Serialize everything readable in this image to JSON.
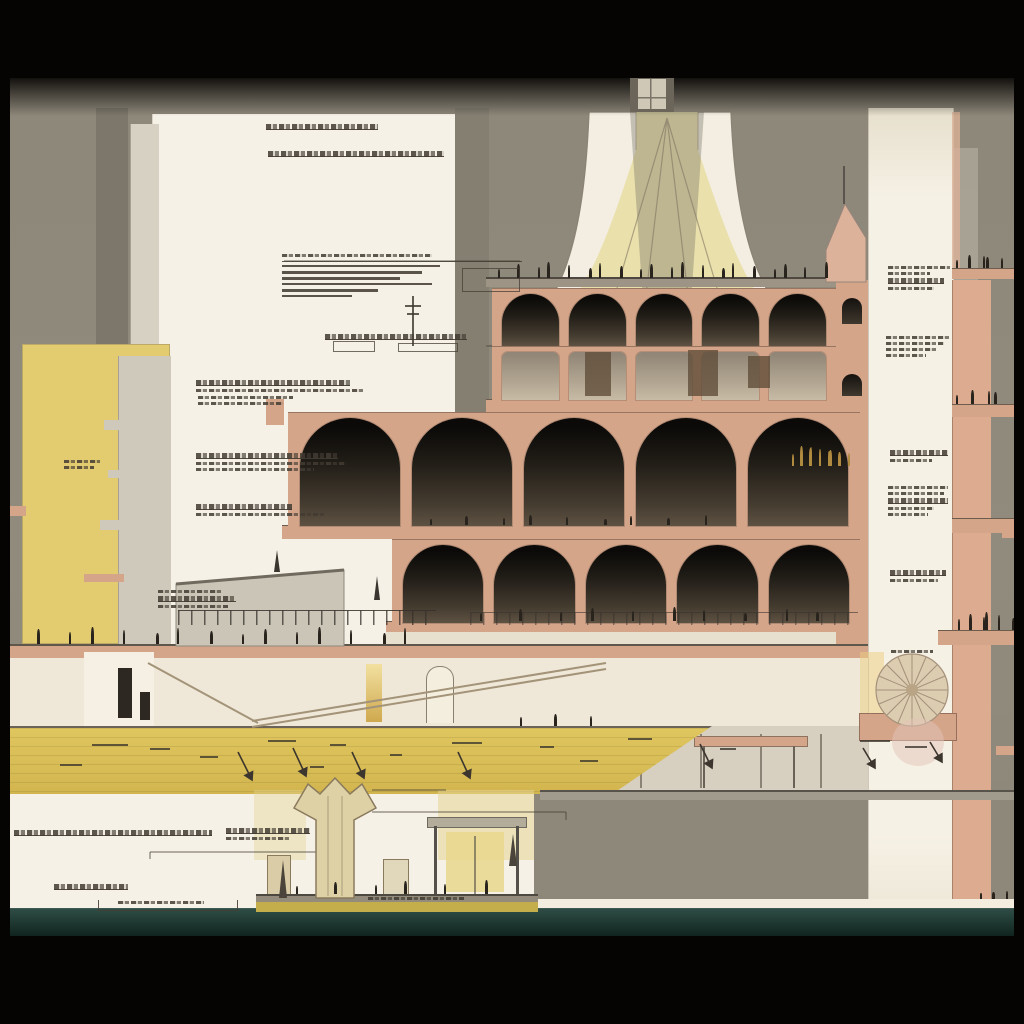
{
  "meta": {
    "description": "Architectural cross-section illustration: multi-storey arcaded building with flared pale-yellow dome, yellow tower, annotation callouts, yellow ramp deck, waterside pavilion with trumpet column, white pier column and salmon balconies with figure silhouettes, framed in black",
    "style": "sepia sectional drawing"
  },
  "palette": {
    "bg": "#8d8779",
    "paper": "#f6f1e7",
    "paper-dim": "#efe8d8",
    "salmon": "#d5a58a",
    "salmon2": "#dcab90",
    "ytower": "#e3cb70",
    "deck-yellow": "#dcc15c",
    "dome-fabric": "#e9e0ab",
    "dome-rim": "#f3eee1",
    "water-top": "#2e4d45",
    "water-bottom": "#0d1f1b",
    "ink": "#474037",
    "fig": "#28231c",
    "gold-fig": "#b08a3e",
    "glow": "#e9d88e",
    "frame": "#050403"
  },
  "scene": {
    "arch_rows": [
      {
        "x": 492,
        "y": 288,
        "w": 344,
        "h": 58,
        "count": 5,
        "pier": 10,
        "fill": "dark"
      },
      {
        "x": 492,
        "y": 346,
        "w": 344,
        "h": 54,
        "count": 5,
        "pier": 10,
        "fill": "light"
      },
      {
        "x": 288,
        "y": 412,
        "w": 572,
        "h": 114,
        "count": 5,
        "pier": 12,
        "fill": "dark"
      },
      {
        "x": 392,
        "y": 539,
        "w": 468,
        "h": 84,
        "count": 5,
        "pier": 11,
        "fill": "dark"
      }
    ],
    "panels": [
      [
        585,
        352,
        26,
        44
      ],
      [
        688,
        350,
        30,
        46
      ],
      [
        748,
        356,
        22,
        32
      ]
    ],
    "rails": [
      {
        "x": 178,
        "y": 610,
        "w": 258,
        "h": 14,
        "o": 0.95
      },
      {
        "x": 470,
        "y": 612,
        "w": 388,
        "h": 12,
        "o": 0.65
      }
    ],
    "figures": [
      {
        "x": 498,
        "y": 258,
        "w": 336,
        "count": 20,
        "min": 9,
        "vr": 8,
        "h": 20
      },
      {
        "x": 430,
        "y": 507,
        "w": 300,
        "count": 9,
        "min": 6,
        "vr": 5
      },
      {
        "x": 792,
        "y": 444,
        "w": 54,
        "count": 9,
        "min": 12,
        "vr": 9,
        "h": 22,
        "color": "#b08a3e"
      },
      {
        "x": 6,
        "y": 626,
        "w": 428,
        "count": 15,
        "min": 10,
        "vr": 8
      },
      {
        "x": 480,
        "y": 603,
        "w": 372,
        "count": 10,
        "min": 8,
        "vr": 7
      },
      {
        "x": 520,
        "y": 708,
        "w": 96,
        "count": 3,
        "min": 9,
        "vr": 5
      },
      {
        "x": 956,
        "y": 386,
        "w": 52,
        "count": 4,
        "min": 9,
        "vr": 6
      },
      {
        "x": 958,
        "y": 612,
        "w": 56,
        "count": 6,
        "min": 11,
        "vr": 8
      },
      {
        "x": 956,
        "y": 250,
        "w": 52,
        "count": 5,
        "min": 8,
        "vr": 6
      },
      {
        "x": 296,
        "y": 876,
        "w": 218,
        "count": 6,
        "min": 8,
        "vr": 7
      },
      {
        "x": 980,
        "y": 881,
        "w": 30,
        "count": 3,
        "min": 6,
        "vr": 4
      }
    ],
    "annotations": [
      {
        "x": 266,
        "y": 124,
        "lines": [
          {
            "w": 112,
            "u": 1
          }
        ]
      },
      {
        "x": 268,
        "y": 151,
        "lines": [
          {
            "w": 176,
            "u": 1
          }
        ]
      },
      {
        "x": 325,
        "y": 334,
        "lines": [
          {
            "w": 142,
            "u": 1
          }
        ]
      },
      {
        "x": 196,
        "y": 380,
        "lines": [
          {
            "w": 154,
            "u": 1
          },
          {
            "w": 168
          }
        ]
      },
      {
        "x": 196,
        "y": 394,
        "lines": []
      },
      {
        "x": 198,
        "y": 396,
        "lines": [
          {
            "w": 95
          },
          {
            "w": 85
          }
        ]
      },
      {
        "x": 64,
        "y": 460,
        "lines": [
          {
            "w": 36
          },
          {
            "w": 30
          }
        ]
      },
      {
        "x": 196,
        "y": 453,
        "lines": [
          {
            "w": 142,
            "u": 1
          },
          {
            "w": 150
          },
          {
            "w": 118
          }
        ]
      },
      {
        "x": 196,
        "y": 504,
        "lines": [
          {
            "w": 96,
            "u": 1
          },
          {
            "w": 128
          }
        ]
      },
      {
        "x": 158,
        "y": 590,
        "lines": [
          {
            "w": 64
          },
          {
            "w": 78,
            "u": 1
          },
          {
            "w": 70
          }
        ]
      },
      {
        "x": 888,
        "y": 266,
        "lines": [
          {
            "w": 62
          },
          {
            "w": 42
          },
          {
            "w": 56,
            "u": 1
          },
          {
            "w": 46
          }
        ]
      },
      {
        "x": 886,
        "y": 336,
        "lines": [
          {
            "w": 64
          },
          {
            "w": 58
          },
          {
            "w": 50
          },
          {
            "w": 40
          }
        ]
      },
      {
        "x": 890,
        "y": 450,
        "lines": [
          {
            "w": 58,
            "u": 1
          },
          {
            "w": 42
          }
        ]
      },
      {
        "x": 888,
        "y": 486,
        "lines": [
          {
            "w": 60
          },
          {
            "w": 56
          },
          {
            "w": 60,
            "u": 1
          },
          {
            "w": 46
          },
          {
            "w": 40
          }
        ]
      },
      {
        "x": 890,
        "y": 570,
        "lines": [
          {
            "w": 56,
            "u": 1
          },
          {
            "w": 48
          }
        ]
      },
      {
        "x": 891,
        "y": 650,
        "lines": [
          {
            "w": 42
          }
        ]
      },
      {
        "x": 14,
        "y": 830,
        "lines": [
          {
            "w": 198,
            "u": 1
          }
        ]
      },
      {
        "x": 226,
        "y": 828,
        "lines": [
          {
            "w": 84,
            "u": 1
          },
          {
            "w": 64
          }
        ]
      },
      {
        "x": 54,
        "y": 884,
        "lines": [
          {
            "w": 74,
            "u": 1
          }
        ]
      },
      {
        "x": 118,
        "y": 901,
        "lines": [
          {
            "w": 86
          }
        ]
      },
      {
        "x": 368,
        "y": 897,
        "lines": [
          {
            "w": 96
          }
        ]
      },
      {
        "x": 282,
        "y": 254,
        "lines": [
          {
            "w": 150
          }
        ]
      }
    ],
    "bars": [
      [
        282,
        261,
        240,
        1
      ],
      [
        282,
        265,
        158,
        2
      ],
      [
        282,
        271,
        140,
        3
      ],
      [
        282,
        277,
        118,
        3
      ],
      [
        282,
        283,
        150,
        2
      ],
      [
        282,
        289,
        96,
        3
      ],
      [
        282,
        295,
        70,
        2
      ],
      [
        98,
        910,
        140,
        1
      ],
      [
        98,
        900,
        1,
        10
      ],
      [
        237,
        900,
        1,
        10
      ]
    ],
    "boxes": [
      [
        333,
        341,
        40,
        9
      ],
      [
        398,
        343,
        58,
        7
      ],
      [
        462,
        268,
        56,
        22
      ]
    ],
    "dashes": [
      [
        92,
        744,
        36
      ],
      [
        150,
        748,
        20
      ],
      [
        200,
        756,
        18
      ],
      [
        268,
        740,
        28
      ],
      [
        330,
        744,
        16
      ],
      [
        390,
        754,
        12
      ],
      [
        452,
        742,
        30
      ],
      [
        540,
        746,
        14
      ],
      [
        580,
        760,
        18
      ],
      [
        628,
        738,
        24
      ],
      [
        720,
        748,
        16
      ],
      [
        860,
        740,
        30
      ],
      [
        905,
        746,
        22
      ],
      [
        60,
        764,
        22
      ],
      [
        310,
        766,
        14
      ]
    ],
    "arrows": [
      [
        238,
        752,
        252,
        780
      ],
      [
        293,
        748,
        306,
        776
      ],
      [
        352,
        752,
        364,
        778
      ],
      [
        458,
        752,
        470,
        778
      ],
      [
        700,
        744,
        712,
        768
      ],
      [
        863,
        748,
        875,
        768
      ],
      [
        930,
        742,
        942,
        762
      ]
    ]
  }
}
